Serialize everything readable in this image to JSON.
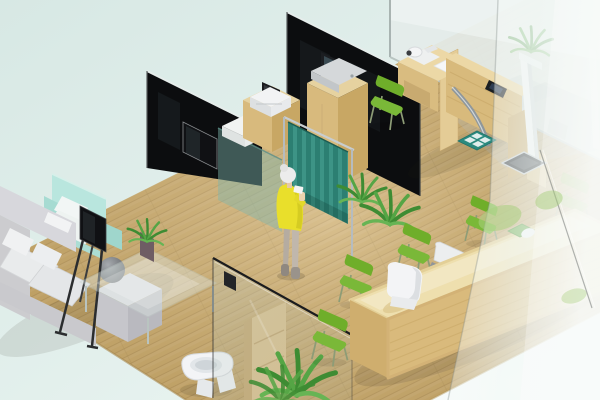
{
  "scene": {
    "description": "Isometric 3D rendering of a small clinic interior: waiting lounge with corner sofa and mint armchair, display screen on an easel, glass coffee table with a plant, black glass partition walls with a wall-mounted screen, teal privacy curtain with an elderly woman in a yellow dress beside it, wooden cabinets carrying medical devices, an examination desk with instruments, height rod and weighing scale behind frosted glass, a toilet behind a clear glass partition, potted plants, and a long wooden reception counter lined with green chairs.",
    "visible_text": "none"
  },
  "palette": {
    "background_top": "#d7e8e4",
    "background_bottom": "#eef7f4",
    "floor_wood": "#c9a96b",
    "floor_plank_line": "#ab8c55",
    "wall_glass_black": "#0c0d0f",
    "tv_black": "#101114",
    "curtain_teal_dark": "#2c7f72",
    "curtain_teal_light": "#3d9486",
    "sofa_gray": "#d7d7dc",
    "sofa_cushion_white": "#e9ebec",
    "armchair_mint": "#b9e6de",
    "chair_green": "#6fae2a",
    "chair_green_seat": "#7ab838",
    "plant_green": "#3e8c33",
    "plant_green_light": "#55a545",
    "person_dress_yellow": "#e9df2b",
    "wood_cabinet": "#e6d2a0",
    "exam_wood": "#ecd8a6",
    "reception_wood_top": "#eedfae",
    "reception_wood_front": "#d9ba7c",
    "frosted_glass": "#e4ecea",
    "toilet_white": "#f3f4f6",
    "scale_dark": "#33363a",
    "mat_teal": "#2a8a7e",
    "leaf_decal": "#a9cf7f"
  },
  "inventory": [
    "corner sofa",
    "mint armchair",
    "screen on easel stand",
    "glass coffee table",
    "potted aloe plant",
    "black glass partition walls",
    "wall-mounted display",
    "teal privacy curtain",
    "woman in yellow dress",
    "medical cabinets with printer and monitor devices",
    "examination desk with camera instrument",
    "green side chairs",
    "stadiometer height rod",
    "weighing scale",
    "teal floor mat",
    "frosted glass walls",
    "toilet",
    "storage shelf",
    "floor plants",
    "wooden reception counter",
    "white molded chair",
    "gray office chair",
    "accessory tray with mouse",
    "leaf decals on glass"
  ]
}
